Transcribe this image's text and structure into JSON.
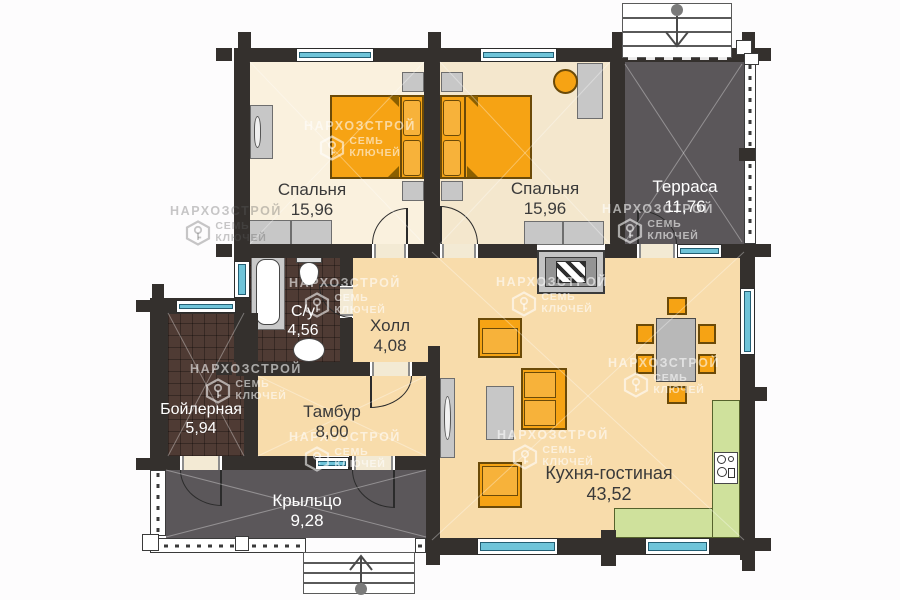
{
  "watermark": {
    "brand": "НАРХОЗСТРОЙ",
    "key_line1": "СЕМЬ",
    "key_line2": "КЛЮЧЕЙ"
  },
  "rooms": {
    "bedroom1": {
      "name": "Спальня",
      "area": "15,96"
    },
    "bedroom2": {
      "name": "Спальня",
      "area": "15,96"
    },
    "terrace": {
      "name": "Терраса",
      "area": "11,76"
    },
    "bathroom": {
      "name": "С/у",
      "area": "4,56"
    },
    "hall": {
      "name": "Холл",
      "area": "4,08"
    },
    "boiler": {
      "name": "Бойлерная",
      "area": "5,94"
    },
    "vestibule": {
      "name": "Тамбур",
      "area": "8,00"
    },
    "porch": {
      "name": "Крыльцо",
      "area": "9,28"
    },
    "kitchen_living": {
      "name": "Кухня-гостиная",
      "area": "43,52"
    }
  },
  "colors": {
    "wall": "#34302d",
    "floor_light": "#faf1de",
    "floor_tan": "#f4e7cd",
    "floor_wheat": "#f8dcab",
    "floor_dark": "#5b575a",
    "floor_tile": "#4f3b34",
    "window_glass": "#6fc4d9",
    "furniture_orange": "#f6a314",
    "furniture_gray": "#c7c7c7",
    "counter_green": "#cfe19c"
  }
}
